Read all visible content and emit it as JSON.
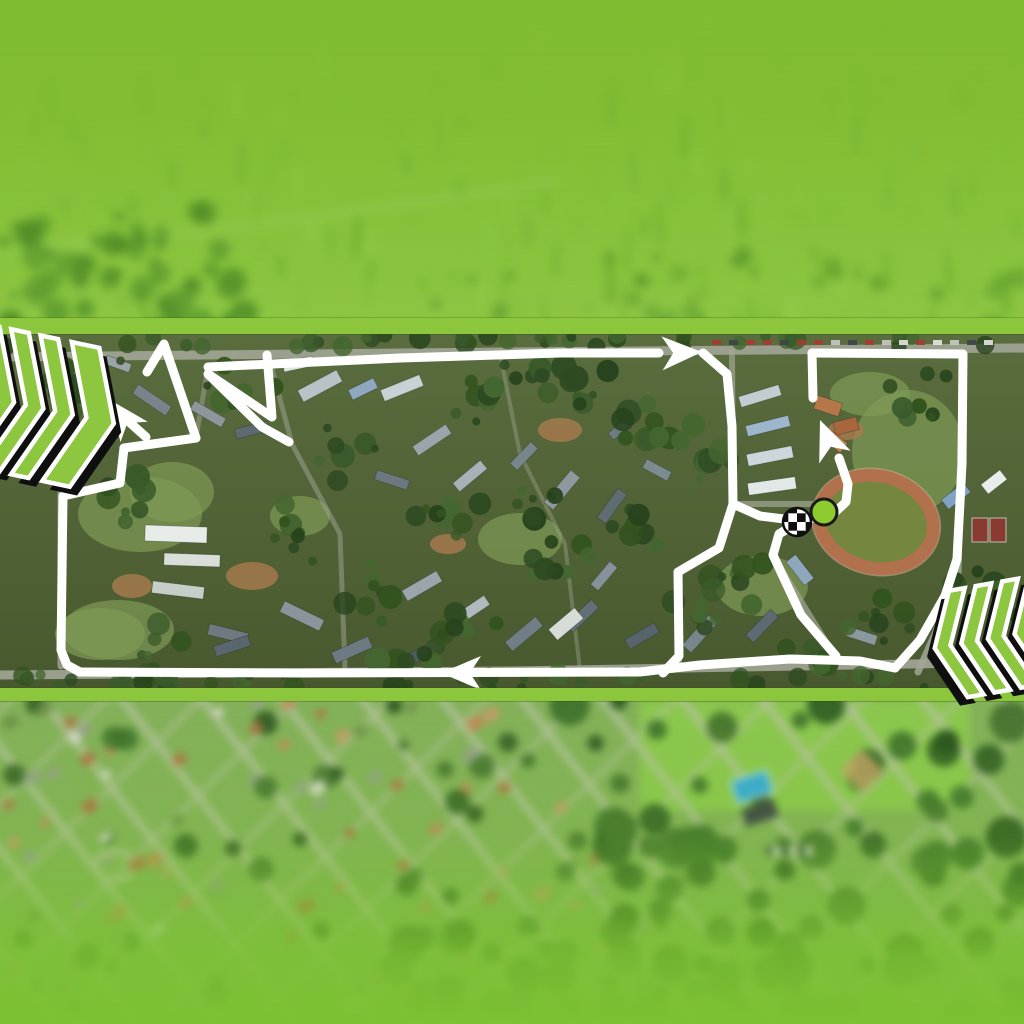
{
  "app": {
    "name": "race-route-aerial-map-graphic"
  },
  "palette": {
    "brand_green": "#8cc63c",
    "route_white": "#ffffff",
    "chevron_green": "#8dc63f",
    "chevron_outline": "#ffffff",
    "chevron_shadow": "#0f0f0f",
    "start_dot_fill": "#8ecb2f",
    "start_dot_stroke": "#1a1a1a",
    "checker_black": "#0f0f0f",
    "checker_white": "#ffffff",
    "road_color": "#a2a697"
  },
  "sections": {
    "top_aerial": {
      "y": 0,
      "h": 334,
      "base_top": "#7cb82d",
      "base_bottom": "#8fc846",
      "tint": "rgba(130,195,50,0.38)"
    },
    "top_band": {
      "y": 318,
      "h": 16,
      "color": "#8cc63c"
    },
    "map_band": {
      "y": 334,
      "h": 354,
      "base_top": "#5a6d3e",
      "base_bottom": "#49592f"
    },
    "bottom_band": {
      "y": 688,
      "h": 13,
      "color": "#8cc63c"
    },
    "bottom_aerial": {
      "y": 701,
      "h": 323,
      "base": "#84b15a",
      "fade_color": "#7cc133"
    }
  },
  "route": {
    "stroke": "#ffffff",
    "width": 9,
    "segments": [
      {
        "name": "top-road",
        "pts": [
          [
            208,
            33
          ],
          [
            400,
            24
          ],
          [
            560,
            19
          ],
          [
            659,
            19
          ]
        ]
      },
      {
        "name": "peak",
        "pts": [
          [
            147,
            38
          ],
          [
            164,
            10
          ],
          [
            196,
            104
          ]
        ]
      },
      {
        "name": "west-bar",
        "pts": [
          [
            196,
            104
          ],
          [
            124,
            114
          ]
        ]
      },
      {
        "name": "west-outer",
        "pts": [
          [
            124,
            114
          ],
          [
            120,
            149
          ],
          [
            63,
            162
          ],
          [
            61,
            316
          ],
          [
            67,
            331
          ],
          [
            80,
            338
          ]
        ]
      },
      {
        "name": "bottom-road",
        "pts": [
          [
            80,
            338
          ],
          [
            300,
            339
          ],
          [
            640,
            338
          ],
          [
            700,
            331
          ],
          [
            790,
            325
          ],
          [
            860,
            327
          ],
          [
            895,
            334
          ]
        ]
      },
      {
        "name": "east-loop",
        "pts": [
          [
            895,
            334
          ],
          [
            920,
            306
          ],
          [
            945,
            262
          ],
          [
            957,
            225
          ],
          [
            962,
            130
          ],
          [
            963,
            20
          ],
          [
            812,
            19
          ]
        ]
      },
      {
        "name": "east-upper",
        "pts": [
          [
            812,
            19
          ],
          [
            813,
            64
          ]
        ]
      },
      {
        "name": "finish-spur",
        "pts": [
          [
            839,
            124
          ],
          [
            848,
            150
          ],
          [
            846,
            168
          ],
          [
            833,
            180
          ],
          [
            800,
            187
          ],
          [
            760,
            182
          ],
          [
            733,
            170
          ]
        ]
      },
      {
        "name": "mid-vertical",
        "pts": [
          [
            703,
            19
          ],
          [
            727,
            40
          ],
          [
            732,
            92
          ],
          [
            733,
            170
          ]
        ]
      },
      {
        "name": "inner-descent",
        "pts": [
          [
            733,
            170
          ],
          [
            719,
            214
          ],
          [
            678,
            238
          ],
          [
            679,
            322
          ],
          [
            663,
            339
          ]
        ]
      },
      {
        "name": "finish-diagonal",
        "pts": [
          [
            836,
            322
          ],
          [
            801,
            281
          ],
          [
            773,
            221
          ],
          [
            779,
            200
          ],
          [
            797,
            189
          ]
        ]
      },
      {
        "name": "hairpin",
        "pts": [
          [
            267,
            21
          ],
          [
            272,
            83
          ],
          [
            208,
            40
          ],
          [
            262,
            93
          ],
          [
            289,
            108
          ]
        ]
      },
      {
        "name": "northwest-arrow-shaft",
        "pts": [
          [
            146,
            103
          ],
          [
            128,
            87
          ]
        ]
      }
    ],
    "arrows": [
      {
        "name": "arrow-east",
        "x": 702,
        "y": 18,
        "angle": -2
      },
      {
        "name": "arrow-west",
        "x": 441,
        "y": 339,
        "angle": 180
      },
      {
        "name": "arrow-northwest",
        "x": 110,
        "y": 66,
        "angle": -127
      },
      {
        "name": "arrow-north",
        "x": 820,
        "y": 86,
        "angle": -112
      }
    ],
    "arrow_len": 40,
    "arrow_w": 34
  },
  "markers": {
    "finish_checkered": {
      "x": 797,
      "y": 188,
      "r": 14
    },
    "start_dot": {
      "x": 824,
      "y": 178,
      "r": 13
    }
  },
  "map": {
    "roads": [
      {
        "pts": [
          [
            0,
            23
          ],
          [
            512,
            18
          ],
          [
            1024,
            14
          ]
        ],
        "w": 9,
        "o": 0.9
      },
      {
        "pts": [
          [
            0,
            341
          ],
          [
            512,
            337
          ],
          [
            1024,
            328
          ]
        ],
        "w": 9,
        "o": 0.9
      },
      {
        "pts": [
          [
            61,
            118
          ],
          [
            61,
            332
          ]
        ],
        "w": 7,
        "o": 0.8
      },
      {
        "pts": [
          [
            963,
            18
          ],
          [
            958,
            240
          ],
          [
            935,
            300
          ],
          [
            918,
            338
          ]
        ],
        "w": 7,
        "o": 0.85
      },
      {
        "pts": [
          [
            732,
            18
          ],
          [
            733,
            170
          ],
          [
            719,
            214
          ],
          [
            678,
            238
          ],
          [
            679,
            332
          ]
        ],
        "w": 6,
        "o": 0.7
      },
      {
        "pts": [
          [
            733,
            170
          ],
          [
            852,
            170
          ]
        ],
        "w": 6,
        "o": 0.7
      },
      {
        "pts": [
          [
            836,
            324
          ],
          [
            772,
            220
          ],
          [
            779,
            198
          ]
        ],
        "w": 6,
        "o": 0.7
      },
      {
        "pts": [
          [
            268,
            20
          ],
          [
            292,
            110
          ],
          [
            340,
            200
          ],
          [
            345,
            336
          ]
        ],
        "w": 5,
        "o": 0.5
      },
      {
        "pts": [
          [
            500,
            20
          ],
          [
            520,
            120
          ],
          [
            565,
            210
          ],
          [
            580,
            336
          ]
        ],
        "w": 4,
        "o": 0.4
      },
      {
        "pts": [
          [
            208,
            33
          ],
          [
            196,
            104
          ],
          [
            150,
            110
          ]
        ],
        "w": 5,
        "o": 0.5
      }
    ],
    "grass": [
      [
        140,
        180,
        62,
        38
      ],
      [
        520,
        205,
        42,
        26
      ],
      [
        908,
        118,
        56,
        62
      ],
      [
        118,
        296,
        56,
        30
      ],
      [
        300,
        182,
        30,
        20
      ],
      [
        762,
        252,
        46,
        30
      ],
      [
        100,
        300,
        45,
        26
      ],
      [
        172,
        158,
        42,
        30
      ],
      [
        870,
        60,
        40,
        22
      ]
    ],
    "dirt": [
      [
        252,
        242,
        26,
        14
      ],
      [
        560,
        96,
        22,
        12
      ],
      [
        846,
        96,
        18,
        10
      ],
      [
        132,
        252,
        20,
        12
      ],
      [
        448,
        210,
        18,
        10
      ]
    ],
    "buildings": [
      [
        320,
        52,
        44,
        13,
        -28,
        "#b9c2c6"
      ],
      [
        363,
        55,
        28,
        11,
        -26,
        "#8fa7bf"
      ],
      [
        402,
        54,
        42,
        12,
        -22,
        "#c8d1d4"
      ],
      [
        298,
        30,
        30,
        10,
        -12,
        "#dde3e0"
      ],
      [
        252,
        96,
        34,
        10,
        -14,
        "#5d6a70"
      ],
      [
        208,
        80,
        36,
        10,
        30,
        "#8f979c"
      ],
      [
        152,
        66,
        40,
        11,
        34,
        "#78838a"
      ],
      [
        118,
        30,
        26,
        9,
        20,
        "#9aa4a8"
      ],
      [
        432,
        106,
        40,
        11,
        -34,
        "#9aa4aa"
      ],
      [
        392,
        146,
        34,
        10,
        18,
        "#6b7880"
      ],
      [
        470,
        142,
        36,
        11,
        -40,
        "#a8b2b6"
      ],
      [
        524,
        122,
        30,
        10,
        -46,
        "#78858c"
      ],
      [
        562,
        156,
        42,
        12,
        -50,
        "#8e999e"
      ],
      [
        612,
        172,
        36,
        11,
        -54,
        "#5f6c72"
      ],
      [
        657,
        136,
        28,
        10,
        28,
        "#7d8a90"
      ],
      [
        620,
        95,
        24,
        9,
        -40,
        "#6d7a82"
      ],
      [
        176,
        200,
        62,
        16,
        2,
        "#e8ece9"
      ],
      [
        192,
        226,
        56,
        12,
        2,
        "#d9ded9"
      ],
      [
        178,
        256,
        52,
        12,
        7,
        "#c7cdc7"
      ],
      [
        228,
        300,
        40,
        11,
        14,
        "#6f7a80"
      ],
      [
        302,
        282,
        44,
        12,
        26,
        "#8a949a"
      ],
      [
        422,
        252,
        40,
        12,
        -30,
        "#9aa6ac"
      ],
      [
        472,
        276,
        36,
        11,
        -34,
        "#b0babe"
      ],
      [
        524,
        300,
        40,
        12,
        -40,
        "#717e85"
      ],
      [
        582,
        282,
        36,
        11,
        -44,
        "#626f76"
      ],
      [
        604,
        242,
        30,
        10,
        -50,
        "#86929a"
      ],
      [
        642,
        302,
        34,
        11,
        -30,
        "#57646c"
      ],
      [
        566,
        290,
        34,
        14,
        -40,
        "#d7dcd7"
      ],
      [
        232,
        312,
        36,
        11,
        -18,
        "#59666e"
      ],
      [
        352,
        316,
        40,
        12,
        -24,
        "#6d7a82"
      ],
      [
        424,
        318,
        36,
        11,
        -28,
        "#4f5c64"
      ],
      [
        700,
        300,
        40,
        12,
        -48,
        "#78858d"
      ],
      [
        762,
        292,
        36,
        11,
        -46,
        "#5d6a72"
      ],
      [
        862,
        302,
        30,
        10,
        18,
        "#8b989e"
      ],
      [
        760,
        62,
        42,
        11,
        -17,
        "#c3ccd1"
      ],
      [
        768,
        92,
        44,
        11,
        -14,
        "#9db6cc"
      ],
      [
        770,
        122,
        46,
        12,
        -11,
        "#cdd6da"
      ],
      [
        772,
        152,
        48,
        12,
        -8,
        "#e2e8e6"
      ],
      [
        828,
        72,
        26,
        14,
        18,
        "#b5764a"
      ],
      [
        846,
        92,
        24,
        13,
        -14,
        "#a8663e"
      ],
      [
        836,
        108,
        20,
        12,
        38,
        "#c08354"
      ],
      [
        956,
        162,
        28,
        12,
        -38,
        "#7fa3c4"
      ],
      [
        994,
        148,
        24,
        12,
        -38,
        "#e8ecea"
      ],
      [
        800,
        236,
        30,
        12,
        52,
        "#8fa7bd"
      ]
    ],
    "track": {
      "cx": 876,
      "cy": 188,
      "rx": 58,
      "ry": 46,
      "rot": 14,
      "ring": "#b0714c",
      "infield": "#75863f",
      "lane": "#caa78d"
    },
    "courts": {
      "x": 972,
      "y": 184,
      "w": 16,
      "h": 24,
      "gap": 18,
      "color": "#8a3b31"
    }
  },
  "bottom_map": {
    "street_color": "#b6c29e",
    "house_colors": [
      "#c4875a",
      "#b06f44",
      "#d8dbd1",
      "#96a08a",
      "#c79a6b",
      "#6f8f49"
    ],
    "forest_colors": [
      "#2e5a22",
      "#3c6f2a",
      "#27511d",
      "#416f2e"
    ],
    "field": {
      "x": 640,
      "y": 0,
      "w": 330,
      "h": 110,
      "color": "#8cc84e"
    },
    "pool": {
      "x": 752,
      "y": 86,
      "w": 38,
      "h": 24,
      "rot": -18,
      "color": "#35aadc"
    },
    "pool_building": {
      "x": 760,
      "y": 112,
      "w": 34,
      "h": 18,
      "rot": -18,
      "color": "#3a4148"
    },
    "roundabout": {
      "cx": 115,
      "cy": 165,
      "rx": 20,
      "ry": 14
    }
  },
  "chevrons": {
    "left": {
      "x": 0,
      "y": 335,
      "w": 118,
      "h": 164,
      "dir": "right",
      "rot": 12,
      "depth": 30,
      "y0": 6,
      "y1": 148,
      "stripes": [
        {
          "x0": -36,
          "w": 18
        },
        {
          "x0": -6,
          "w": 18
        },
        {
          "x0": 24,
          "w": 18
        },
        {
          "x0": 56,
          "w": 28
        }
      ]
    },
    "right": {
      "x": 938,
      "y": 582,
      "w": 86,
      "h": 116,
      "dir": "left",
      "rot": 10,
      "depth": 24,
      "y0": 4,
      "y1": 112,
      "stripes": [
        {
          "x0": -31,
          "w": 16
        },
        {
          "x0": -4,
          "w": 16
        },
        {
          "x0": 23,
          "w": 16
        },
        {
          "x0": 50,
          "w": 16
        }
      ]
    }
  }
}
